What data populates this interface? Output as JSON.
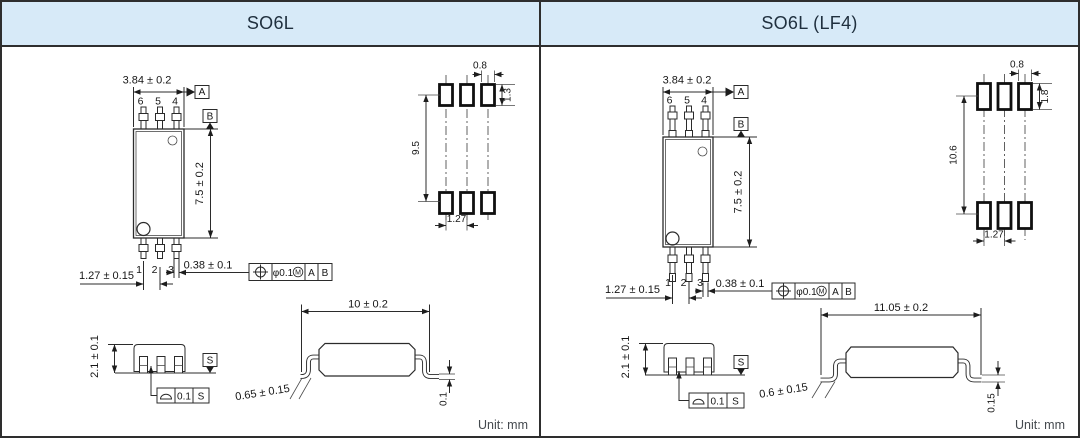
{
  "colors": {
    "header_bg": "#d7eaf8",
    "border": "#2e2e2e",
    "line": "#2b2b2b",
    "text": "#161616",
    "title": "#20303f"
  },
  "panels": [
    {
      "title": "SO6L",
      "top_view": {
        "width_dim": "3.84 ± 0.2",
        "height_dim": "7.5 ± 0.2",
        "pitch_dim": "1.27 ± 0.15",
        "lead_width_dim": "0.38 ± 0.1",
        "pins_top": [
          "6",
          "5",
          "4"
        ],
        "pins_bottom": [
          "1",
          "2",
          "3"
        ],
        "datum_a": "A",
        "datum_b": "B",
        "position_fcf": {
          "tolerance": "φ0.1",
          "modifier": "M",
          "datum_1": "A",
          "datum_2": "B"
        }
      },
      "land_pattern": {
        "pad_width": "0.8",
        "pad_height": "1.3",
        "row_span": "9.5",
        "pad_pitch": "1.27"
      },
      "end_view": {
        "height_dim": "2.1 ± 0.1",
        "seating_datum": "S",
        "seating_fcf": {
          "tolerance": "0.1",
          "datum": "S"
        }
      },
      "side_view": {
        "length_dim": "10 ± 0.2",
        "foot_dim": "0.65 ± 0.15",
        "standoff_dim": "0.1"
      },
      "unit_label": "Unit: mm"
    },
    {
      "title": "SO6L (LF4)",
      "top_view": {
        "width_dim": "3.84 ± 0.2",
        "height_dim": "7.5 ± 0.2",
        "pitch_dim": "1.27 ± 0.15",
        "lead_width_dim": "0.38 ± 0.1",
        "pins_top": [
          "6",
          "5",
          "4"
        ],
        "pins_bottom": [
          "1",
          "2",
          "3"
        ],
        "datum_a": "A",
        "datum_b": "B",
        "position_fcf": {
          "tolerance": "φ0.1",
          "modifier": "M",
          "datum_1": "A",
          "datum_2": "B"
        }
      },
      "land_pattern": {
        "pad_width": "0.8",
        "pad_height": "1.8",
        "row_span": "10.6",
        "pad_pitch": "1.27"
      },
      "end_view": {
        "height_dim": "2.1 ± 0.1",
        "seating_datum": "S",
        "seating_fcf": {
          "tolerance": "0.1",
          "datum": "S"
        }
      },
      "side_view": {
        "length_dim": "11.05 ± 0.2",
        "foot_dim": "0.6 ± 0.15",
        "standoff_dim": "0.15"
      },
      "unit_label": "Unit: mm"
    }
  ]
}
